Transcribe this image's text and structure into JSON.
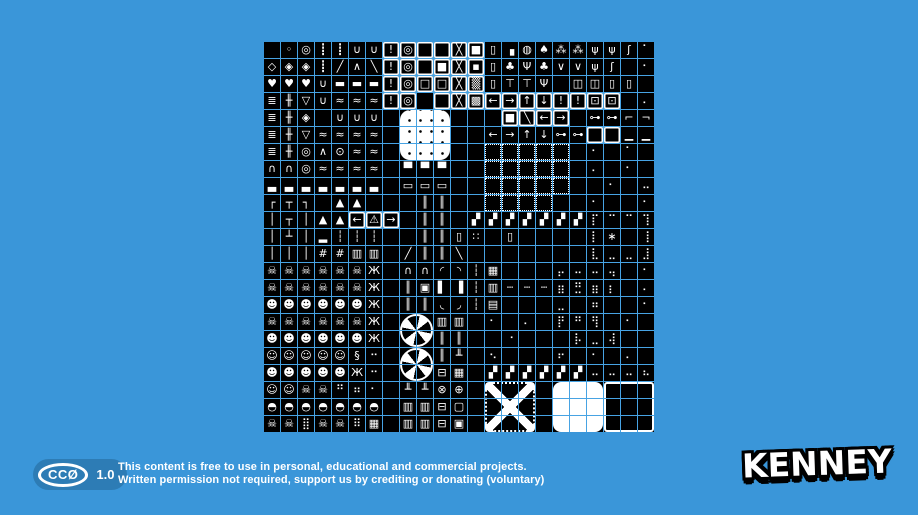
{
  "page": {
    "background": "#3a96d9"
  },
  "license": {
    "badge": {
      "display": "CCØ",
      "version": "1.0",
      "bg": "#2d7cb5"
    },
    "line1": "This content is free to use in personal, educational and commercial projects.",
    "line2": "Written permission not required, support us by crediting or donating (voluntary)"
  },
  "brand": {
    "logo_text": "KENNEY"
  },
  "tilesheet": {
    "cols": 23,
    "rows": 23,
    "tile_px": 16,
    "gap_px": 1,
    "grid_color": "#47a3e3",
    "tile_bg": "#000000",
    "glyph_color": "#ffffff",
    "glyph_rows": [
      " ◦◎┋┋∪∪!◎  ╳■▯▗◍♠⁂⁂ψψʃ⠁",
      "◇◈◈┋╱∧╲!◎ ■╳▪▯♣Ψ♣∨∨ψʃ ⠂",
      "♥♥♥∪▬▬▬!◎□□╳▒▯⊤⊤Ψ ◫◫▯▯ ",
      "≣╫▽∪≈≈≈!◎  ╳▩←→↑↓!!⊡⊡ ⠄",
      "≣╫◈ ∪∪∪       ■╲←→ ⊶⊶⌐¬",
      "≣╫▽≈≈≈≈      ←→↑↓⊶⊶  ▁▁",
      "≣╫◎∧⊙≈≈            ⠂ ⠁ ",
      "∩∩◎≈≈≈≈ ▀▀▀        ⠄ ⠂ ",
      "▃▃▃▃▃▃▃ ▭▭▭         ⠂ ⠤",
      "┌┬┐ ▲▲   ║║        ⠂  ⠂",
      "│┬│▲▲←⚠→ ║║ ▞▞▞▞▞▞▞⡏⠉⠉⢹",
      "│┴│▂┆┆┆  ║║▯∷ ▯    ⡇∗ ⢸",
      "│││##▥▥ ╱║║╲       ⣇⣀⣀⣸",
      "☠☠☠☠☠☠Ж ∩∩◜◝┆▦   ⡤⠤⠤⢤ ⠂",
      "☠☠☠☠☠☠Ж ║▣▌▐┆▥┄┄┄⣶⣛⣶⡆ ⠄",
      "☻☻☻☻☻☻Ж ║║◟◞┆▤   ⣀ ⠶  ⠂",
      "☠☠☠☠☠☠Ж   ▥▥ ⠂ ⠄ ⡟⠛⢻ ⠂ ",
      "☻☻☻☻☻☻Ж   ║║  ⠐   ⡧⣀⢼  ⠁",
      "☺☺☺☺☺§⠒   ║╨ ⠢   ⠖ ⠂ ⠄ ",
      "☻☻☻☻☻Ж⠒   ⊟▦ ▞▞▞▞▞▞⠤⠤⠤⠦",
      "☺☺☠☠⠛⠶⠂ ╨╨⊗⊕           ",
      "◓◓◓◓◓◓◓ ▥▥⊟▢           ",
      "☠☠⣿☠☠⠿▦ ▥▥⊟▣           "
    ],
    "frame_rows": [
      "       ffffff          ",
      "       ffffff          ",
      "       ffffff          ",
      "       ff fffffffffff  ",
      "              ffff     ",
      "                   ff  ",
      "             ddddd     ",
      "             ddddd     ",
      "             ddddd     ",
      "             dddd      ",
      "     fff               ",
      "                       ",
      "                       ",
      "                       ",
      "                       ",
      "                       ",
      "                       ",
      "                       ",
      "                       ",
      "                       ",
      "                       ",
      "                       ",
      "                       "
    ],
    "overlays": [
      {
        "name": "white-blob",
        "kind": "blob",
        "col": 8,
        "row": 4,
        "w": 3,
        "h": 3
      },
      {
        "name": "fan-top",
        "kind": "fan",
        "col": 8,
        "row": 16,
        "w": 2,
        "h": 2
      },
      {
        "name": "fan-bottom",
        "kind": "fan",
        "col": 8,
        "row": 18,
        "w": 2,
        "h": 2
      },
      {
        "name": "x-brace-panel",
        "kind": "xpanel",
        "col": 13,
        "row": 20,
        "w": 3,
        "h": 3
      },
      {
        "name": "white-panel",
        "kind": "whitepanel",
        "col": 17,
        "row": 20,
        "w": 3,
        "h": 3
      },
      {
        "name": "grid-panel",
        "kind": "gridpanel",
        "col": 20,
        "row": 20,
        "w": 3,
        "h": 3
      }
    ],
    "legend": {
      "◦ ◎ ◇ ◈ ♥": "collectibles: rings, gems, hearts",
      "┋ ∪ ╱∧╲ ▬": "chains, hooks, truss and platforms",
      "! ◎ □ ╳ ■ ▩ ▒ (framed)": "crate / box tiles with icons",
      "♠ ♣ Ψ ⊤ ψ ⁂ ʃ ◍": "trees, plants, flowers, moon",
      "◫ ▯ ⊡": "doors, doorways, windows",
      "← → ↑ ↓ ⚠ !": "signs and arrows",
      "⊶": "keys",
      "≣ ╫": "ladders and rails",
      "≈ ∩ ▃ ▲ ▂": "water, bridges, platforms, mountains",
      "┌┬┐│┴ ┆ #": "frames, poles, fences",
      "║ ╨ ╥ ▥": "pipes, trunks, pillars, columns",
      "▞": "hazard striped road",
      "∷": "dice",
      "braille dots ⠿ ⣿ ⡏": "cave walls and speckles",
      "☠ ☻ ☺ ◓ Ж §": "monsters, ghosts, helmet creatures, spider, thread",
      "⊟ ▦ ▣ ▢ ⊗ ⊕": "chests, grates, gauges",
      "d frames": "dotted-border room tiles",
      "overlays": "large multi-tile elements: white blob, fans, X-brace panel, white panel, grid panel"
    }
  }
}
